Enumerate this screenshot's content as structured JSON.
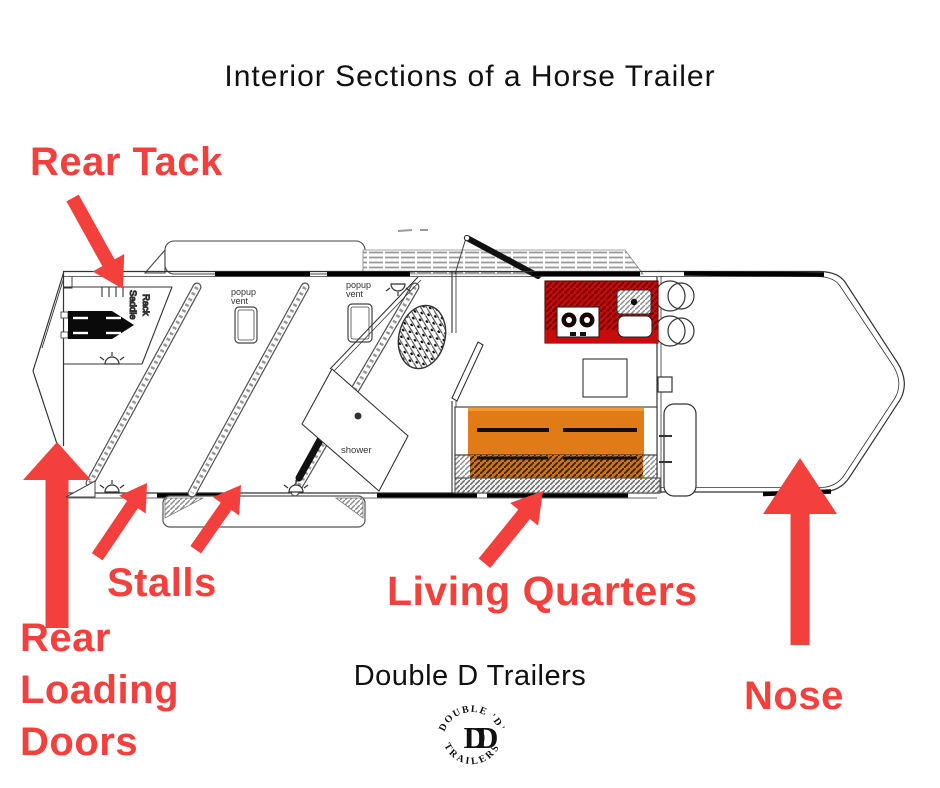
{
  "title": "Interior Sections of a Horse Trailer",
  "section_labels": {
    "rear_tack": "Rear Tack",
    "stalls": "Stalls",
    "living_quarters": "Living Quarters",
    "nose": "Nose",
    "rear_loading_doors": {
      "line1": "Rear",
      "line2": "Loading",
      "line3": "Doors"
    }
  },
  "floorplan_annotations": {
    "saddle_rack_line1": "Saddle",
    "saddle_rack_line2": "Rack",
    "popup_vent_1_line1": "popup",
    "popup_vent_1_line2": "vent",
    "popup_vent_2_line1": "popup",
    "popup_vent_2_line2": "vent",
    "shower": "shower"
  },
  "brand": {
    "name": "Double D Trailers",
    "logo": {
      "arc_top": "DOUBLE 'D'",
      "monogram": "DD",
      "arc_bottom": "TRAILERS"
    }
  },
  "colors": {
    "accent_red": "#f4403c",
    "counter_red": "#c80c0c",
    "sofa_orange": "#e07b17",
    "saddle_rack_blue": "#2233cc",
    "line_gray": "#333333"
  }
}
